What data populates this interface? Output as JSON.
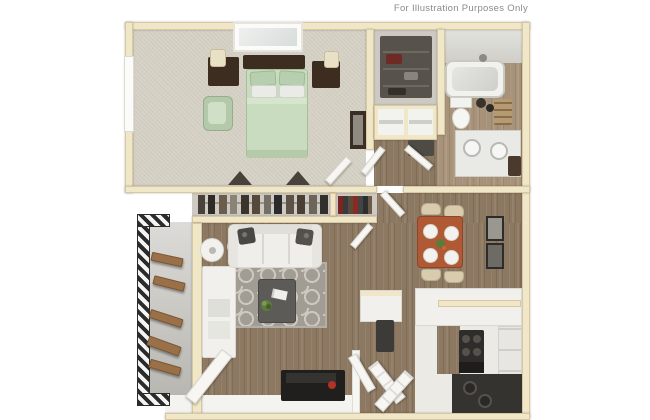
{
  "disclaimer": "For Illustration Purposes Only",
  "palette": {
    "wall": "#f0e7c9",
    "wall-edge": "#d8c7a0",
    "wood": "#8d7962",
    "wood-light": "#a8937a",
    "carpet": "#d6d2c6",
    "closet-floor": "#cccac2",
    "kitchen-floor": "#eceae5",
    "sage": "#c9dcc0",
    "sage-dark": "#b7cfae",
    "terracotta": "#b05a35",
    "rug": "#a19c94",
    "rug-line": "#cdc8c0",
    "dark-wood": "#3c2d20",
    "dark": "#2a2827",
    "tan": "#d9cbae",
    "white-furniture": "#f1f0ec",
    "red-accent": "#b33126",
    "text": "#8a8a8a",
    "hatch": "#2b2b2b",
    "stair-wood": "#9a7048"
  },
  "scene": {
    "type": "3d-top-view-floor-plan",
    "rooms": [
      "bedroom",
      "bedroom-closet",
      "hallway-closet",
      "bathroom",
      "living-room",
      "dining-area",
      "kitchen",
      "entry",
      "exterior-stairs"
    ]
  }
}
